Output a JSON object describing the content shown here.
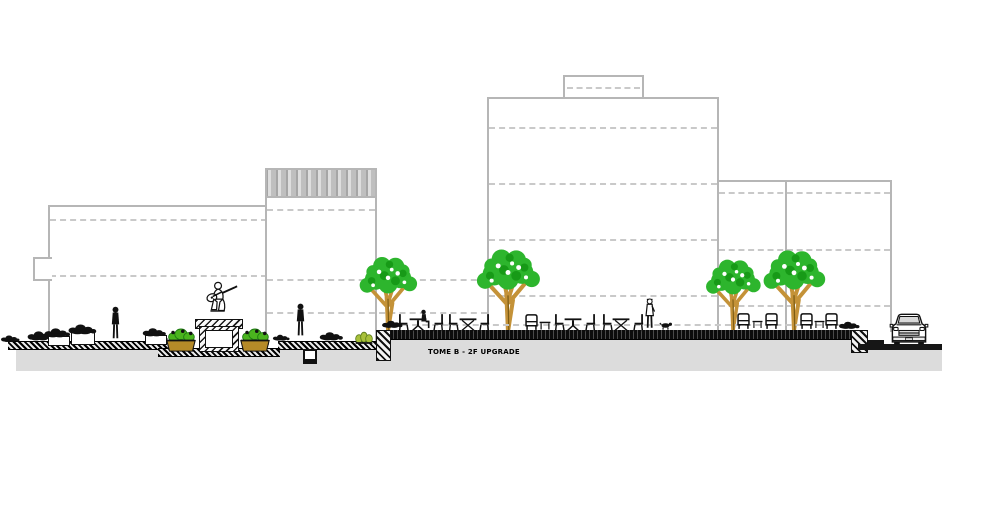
{
  "page": {
    "description": "CAD street elevation drawing: plaza promenade with four background buildings, trees, a guitarist statue on a pedestal, hedges, cafe seating, pedestrians and a parked car"
  },
  "label": {
    "text": "TOME B - 2F UPGRADE"
  },
  "colors": {
    "building_outline": "#b6b6b6",
    "floor_dash": "#c9c9c9",
    "ground_fill": "#dcdcdc",
    "ink": "#111111",
    "tree_green": "#2db52d",
    "tree_green_dark": "#179a17",
    "trunk_tan": "#c49238",
    "plant_green": "#4ab41e",
    "planter_brown": "#b58a28",
    "grass_yellow_green": "#a8c03a"
  },
  "scene": {
    "buildings": [
      {
        "name": "left low-rise",
        "floor_lines": 2
      },
      {
        "name": "ribbed-parapet block",
        "floor_lines": 3
      },
      {
        "name": "tall tower with roof penthouse",
        "floor_lines": 4
      },
      {
        "name": "right block with two bays",
        "floor_lines": 3
      }
    ],
    "trees": 4,
    "statue": "seated guitarist on hatched stone pedestal flanked by planters",
    "furniture": [
      "cafe chairs",
      "pedestal tables",
      "lounge chairs",
      "coffee tables",
      "planter boxes",
      "hedges"
    ],
    "people": [
      "figure near left building",
      "pedestrian on walkway",
      "seated cafe patron",
      "walker with dog"
    ],
    "vehicle": "passenger car parked at right curb"
  }
}
